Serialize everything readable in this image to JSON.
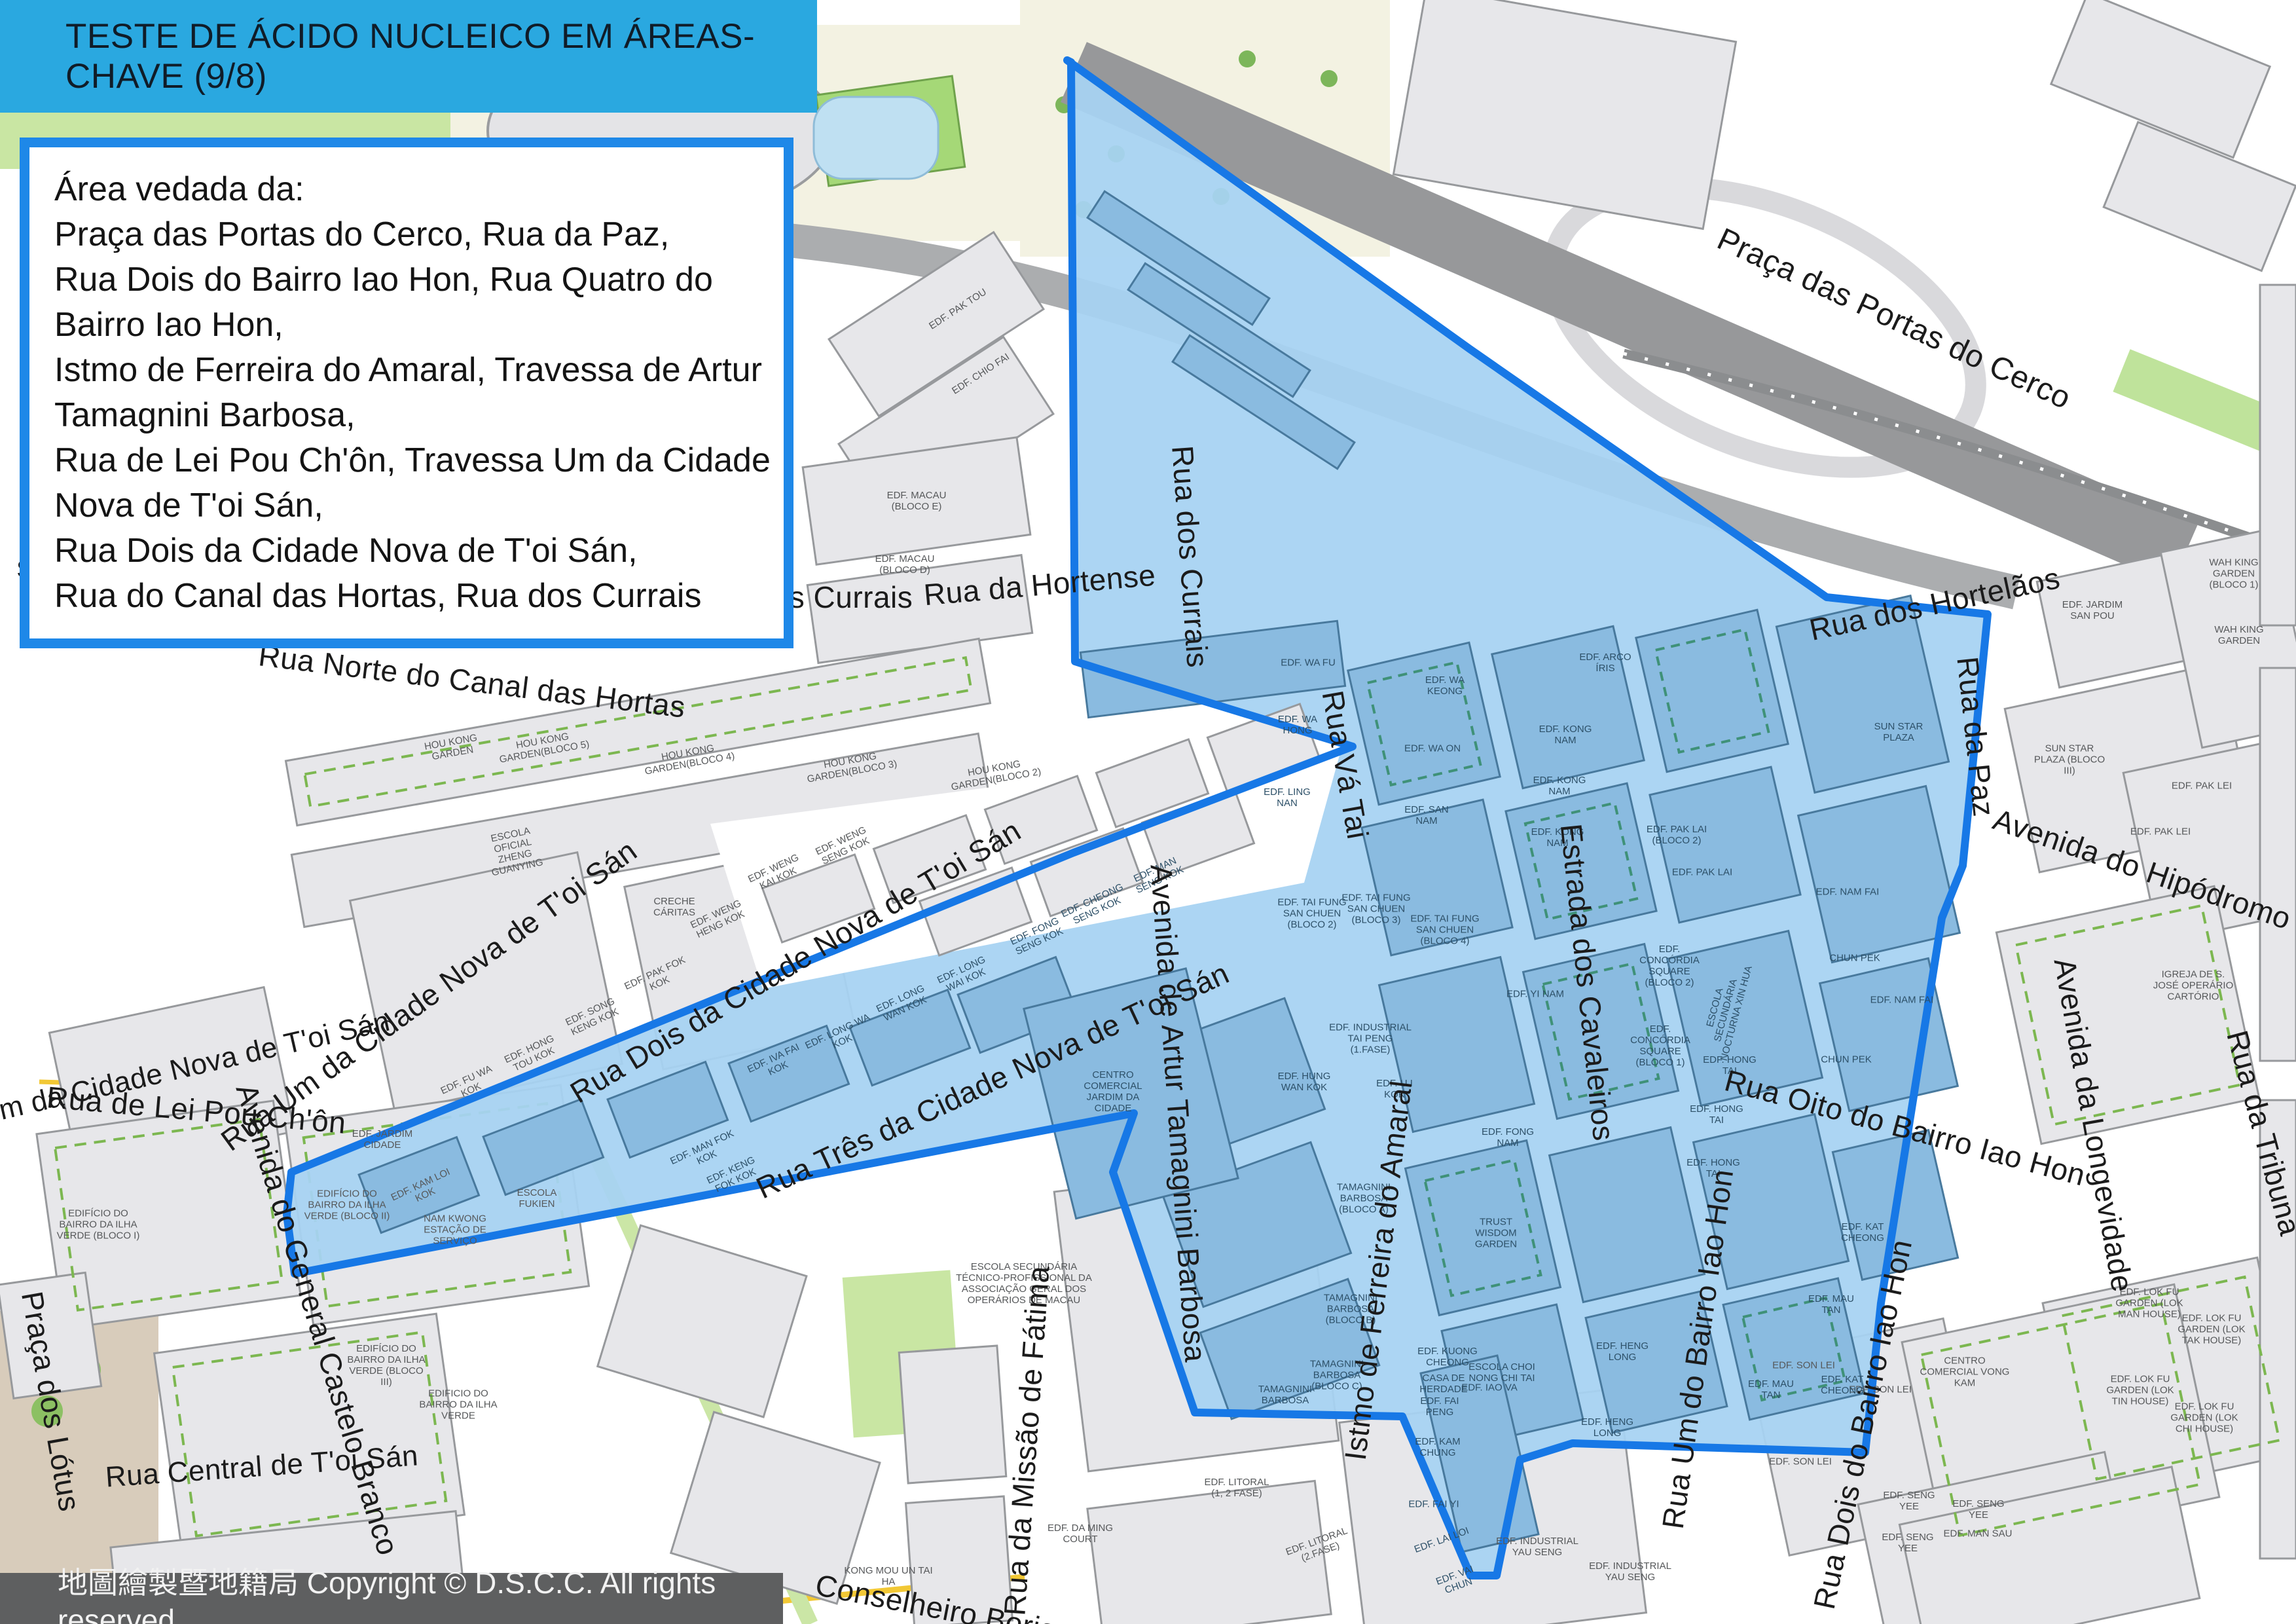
{
  "title": "TESTE DE ÁCIDO NUCLEICO EM ÁREAS-CHAVE (9/8)",
  "info_box": {
    "lines": [
      "Área vedada da:",
      "Praça das Portas do Cerco, Rua da Paz,",
      "Rua Dois do Bairro Iao Hon, Rua Quatro do",
      "Bairro Iao Hon,",
      "Istmo de Ferreira do Amaral, Travessa de Artur",
      "Tamagnini Barbosa,",
      "Rua de Lei Pou Ch'ôn, Travessa Um da Cidade",
      "Nova de T'oi Sán,",
      "Rua Dois da Cidade Nova de T'oi Sán,",
      "Rua do Canal das Hortas, Rua dos Currais"
    ]
  },
  "footer": {
    "text": "地圖繪製暨地籍局 Copyright © D.S.C.C. All rights reserved"
  },
  "colors": {
    "title_bar": "#2aa8e0",
    "info_border": "#1e88e8",
    "zone_fill": "#a7d2f2",
    "zone_border": "#1778e6",
    "footer_bar": "#5e5f60",
    "block_gray": "#e7e7ea",
    "park_green": "#c9e6a3"
  },
  "streets": {
    "pracaPortas": "Praça das Portas do Cerco",
    "ruaHortelaos": "Rua dos Hortelãos",
    "ruaPaz": "Rua da Paz",
    "avHipodromo": "Avenida do Hipódromo",
    "avLongevidade": "Avenida da Longevidade",
    "ruaTribuna": "Rua da Tribuna",
    "ruaOito": "Rua Oito do Bairro Iao Hon",
    "ruaCurrais": "Rua dos Currais",
    "sCurrais": "s Currais",
    "sCurrais2": "s Currais",
    "ruaHortense": "Rua da Hortense",
    "ruaNorte": "Rua Norte do Canal das Hortas",
    "ruaUmCidA": "Rua Um da Cidade Nova de T'oi Sán",
    "ruaUmCidB": "Rua Um da Cidade Nova de T'oi Sán",
    "ruaDoisCid": "Rua Dois da Cidade Nova de T'oi Sán",
    "ruaTresCid": "Rua Três da Cidade Nova de T'oi Sán",
    "avArtur": "Avenida de Artur Tamagnini Barbosa",
    "ruaVaTai": "Rua Vá Tai",
    "estradaCav": "Estrada dos Cavaleiros",
    "istmo": "Istmo de Ferreira do Amaral",
    "ruaUmBairro": "Rua Um do Bairro Iao Hon",
    "ruaDoisBairro": "Rua Dois do Bairro Iao Hon",
    "ruaLeiPou": "Rua de Lei Pou Ch'ôn",
    "avCastelo": "Avenida do General Castelo Branco",
    "pracaLotus": "Praça dos Lótus",
    "ruaCentral": "Rua Central de T'oi Sán",
    "ruaMissao": "Rua da Missão de Fátima",
    "conselheiro": "Conselheiro Borja"
  },
  "buildings": {
    "pakTou": "EDF. PAK TOU",
    "chioFai": "EDF. CHIO FAI",
    "macauE": "EDF. MACAU (BLOCO E)",
    "macauD": "EDF. MACAU (BLOCO D)",
    "hk1": "HOU KONG GARDEN",
    "hk5": "HOU KONG GARDEN(BLOCO 5)",
    "hk4": "HOU KONG GARDEN(BLOCO 4)",
    "hk3": "HOU KONG GARDEN(BLOCO 3)",
    "hk2": "HOU KONG GARDEN(BLOCO 2)",
    "escolaZg": "ESCOLA OFICIAL ZHENG GUANYING",
    "creche": "CRECHE CÁRITAS",
    "fukien": "ESCOLA FUKIEN",
    "namKwong": "NAM KWONG ESTAÇÃO DE SERVIÇO",
    "jardimCidade": "EDF. JARDIM CIDADE",
    "kamLoi": "EDF. KAM LOI KOK",
    "fuWa": "EDF. FU WA KOK",
    "hongTou": "EDF. HONG TOU KOK",
    "songKeng": "EDF. SONG KENG KOK",
    "pakFok": "EDF. PAK FOK KOK",
    "wengHeng": "EDF. WENG HENG KOK",
    "wengKai": "EDF. WENG KAI KOK",
    "wengSeng": "EDF. WENG SENG KOK",
    "ilha1": "EDIFÍCIO DO BAIRRO DA ILHA VERDE (BLOCO I)",
    "ilha2": "EDIFÍCIO DO BAIRRO DA ILHA VERDE (BLOCO II)",
    "ilha3": "EDIFÍCIO DO BAIRRO DA ILHA VERDE (BLOCO III)",
    "ilha": "EDIFICIO DO BAIRRO DA ILHA VERDE",
    "kongMou": "KONG MOU UN TAI HA",
    "ming": "EDF. DA MING COURT",
    "escolaSec": "ESCOLA SECUNDÁRIA TÉCNICO-PROFISSIONAL DA ASSOCIAÇÃO GERAL DOS OPERÁRIOS DE MACAU",
    "litoral12": "EDF. LITORAL (1, 2 FASE)",
    "litoral2": "EDF. LITORAL (2.FASE)",
    "yau1": "EDF. INDUSTRIAL YAU SENG",
    "yau2": "EDF. INDUSTRIAL YAU SENG",
    "vongKam": "CENTRO COMERCIAL VONG KAM",
    "manSau": "EDF. MAN SAU",
    "seng1": "EDF. SENG YEE",
    "seng2": "EDF. SENG YEE",
    "seng3": "EDF. SENG YEE",
    "wah1": "WAH KING GARDEN (BLOCO 1)",
    "wah2": "WAH KING GARDEN",
    "sanPou": "EDF. JARDIM SAN POU",
    "sunStar3": "SUN STAR PLAZA (BLOCO III)",
    "pakLei1": "EDF. PAK LEI",
    "pakLei2": "EDF. PAK LEI",
    "igreja": "IGREJA DE S. JOSÉ OPERÁRIO CARTÓRIO",
    "lokMan": "EDF. LOK FU GARDEN (LOK MAN HOUSE)",
    "lokTak": "EDF. LOK FU GARDEN (LOK TAK HOUSE)",
    "lokTin": "EDF. LOK FU GARDEN (LOK TIN HOUSE)",
    "lokChi": "EDF. LOK FU GARDEN (LOK CHI HOUSE)",
    "son1": "EDF. SON LEI",
    "son2": "EDF. SON LEI",
    "son3": "EDF. SON LEI",
    "sunStarIn": "SUN STAR PLAZA",
    "namFai1": "EDF. NAM FAI",
    "namFai2": "EDF. NAM FAI",
    "waFu": "EDF. WA FU",
    "waKeong": "EDF. WA KEONG",
    "waHong": "EDF. WA HONG",
    "waOn": "EDF. WA ON",
    "lingNan": "EDF. LING NAN",
    "sanNam": "EDF. SAN NAM",
    "kong1": "EDF. KONG NAM",
    "kong2": "EDF. KONG NAM",
    "kong3": "EDF. KONG NAM",
    "arco": "EDF. ARCO ÍRIS",
    "pakLaiB2": "EDF. PAK LAI (BLOCO 2)",
    "pakLai": "EDF. PAK LAI",
    "taiFung2": "EDF. TAI FUNG SAN CHUEN (BLOCO 2)",
    "taiFung3": "EDF. TAI FUNG SAN CHUEN (BLOCO 3)",
    "taiFung4": "EDF. TAI FUNG SAN CHUEN (BLOCO 4)",
    "taiPeng": "EDF. INDUSTRIAL TAI PENG (1.FASE)",
    "yiNam": "EDF. YI NAM",
    "conc2": "EDF. CONCÓRDIA SQUARE (BLOCO 2)",
    "conc1": "EDF. CONCÓRDIA SQUARE (BLOCO 1)",
    "xinHua": "ESCOLA SECUNDÁRIA NOCTURNA XIN HUA",
    "tamA": "TAMAGNINI BARBOSA (BLOCO A)",
    "tamB": "TAMAGNINI BARBOSA (BLOCO B)",
    "tamC": "TAMAGNINI BARBOSA (BLOCO C)",
    "tam": "TAMAGNINI BARBOSA",
    "trust": "TRUST WISDOM GARDEN",
    "choiNong": "ESCOLA CHOI NONG CHI TAI",
    "fongNam": "EDF. FONG NAM",
    "hongTai1": "EDF. HONG TAI",
    "hongTai2": "EDF. HONG TAI",
    "hongTai3": "EDF. HONG TAI",
    "hengLong1": "EDF. HENG LONG",
    "hengLong2": "EDF. HENG LONG",
    "mauTan1": "EDF. MAU TAN",
    "mauTan2": "EDF. MAU TAN",
    "chunPek1": "CHUN PEK",
    "chunPek2": "CHUN PEK",
    "katCheong1": "EDF. KAT CHEONG",
    "katCheong2": "EDF. KAT CHEONG",
    "centro": "CENTRO COMERCIAL JARDIM DA CIDADE",
    "manFok": "EDF. MAN FOK KOK",
    "kengFok": "EDF. KENG FOK KOK",
    "ivaFai": "EDF. IVA FAI KOK",
    "longWa": "EDF. LONG WA KOK",
    "longWan": "EDF. LONG WAN KOK",
    "longWai": "EDF. LONG WAI KOK",
    "fongSeng": "EDF. FONG SENG KOK",
    "cheongSeng": "EDF. CHEONG SENG KOK",
    "manSeng": "EDF. MAN SENG KOK",
    "kuong": "EDF. KUONG CHEONG",
    "casa": "CASA DE HERDADE",
    "faiPeng": "EDF. FAI PENG",
    "kamChung": "EDF. KAM CHUNG",
    "faiYi": "EDF. FAI YI",
    "laiLoi": "EDF. LAI LOI",
    "vaiChun": "EDF. VAI CHUN",
    "iaoVa": "EDF. IAO VA",
    "hungWan": "EDF. HUNG WAN KOK",
    "uiKok": "EDF. U I KOK"
  }
}
